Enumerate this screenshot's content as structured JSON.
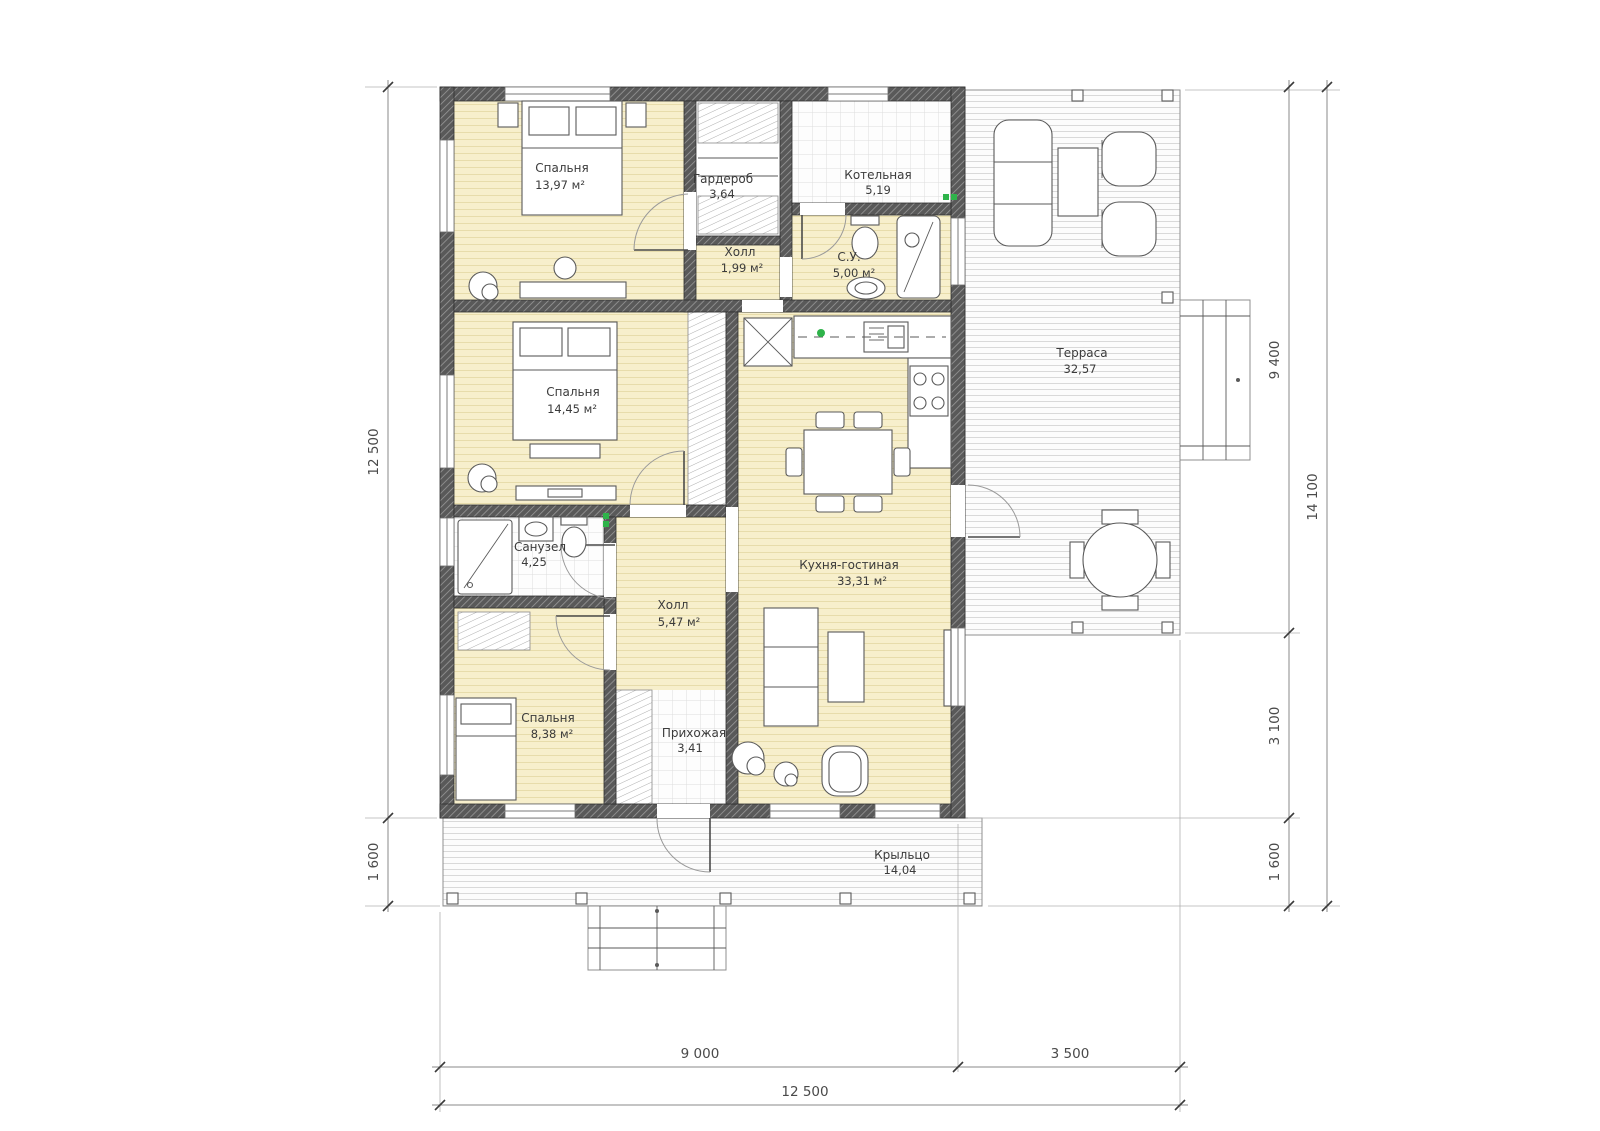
{
  "title": "Вариант 2",
  "colors": {
    "accent": "#3e6a5b",
    "floor_beige": "#f7efcc",
    "wall_gray": "#595959",
    "marker_green": "#2eb34a",
    "dim": "#4a4a4a"
  },
  "rooms": {
    "bedroom1": {
      "name": "Спальня",
      "area": "13,97 м²"
    },
    "wardrobe": {
      "name": "Гардероб",
      "area": "3,64"
    },
    "boiler": {
      "name": "Котельная",
      "area": "5,19"
    },
    "hall1": {
      "name": "Холл",
      "area": "1,99 м²"
    },
    "su": {
      "name": "С.У.",
      "area": "5,00 м²"
    },
    "bedroom2": {
      "name": "Спальня",
      "area": "14,45 м²"
    },
    "bathroom": {
      "name": "Санузел",
      "area": "4,25"
    },
    "hall2": {
      "name": "Холл",
      "area": "5,47 м²"
    },
    "kitchen": {
      "name": "Кухня-гостиная",
      "area": "33,31 м²"
    },
    "bedroom3": {
      "name": "Спальня",
      "area": "8,38 м²"
    },
    "entry": {
      "name": "Прихожая",
      "area": "3,41"
    },
    "terrace": {
      "name": "Терраса",
      "area": "32,57"
    },
    "porch": {
      "name": "Крыльцо",
      "area": "14,04"
    }
  },
  "dims": {
    "left_total": "12 500",
    "left_porch": "1 600",
    "right_terrace": "9 400",
    "right_mid": "3 100",
    "right_porch": "1 600",
    "right_total": "14 100",
    "bottom_main": "9 000",
    "bottom_terrace": "3 500",
    "bottom_total": "12 500"
  }
}
